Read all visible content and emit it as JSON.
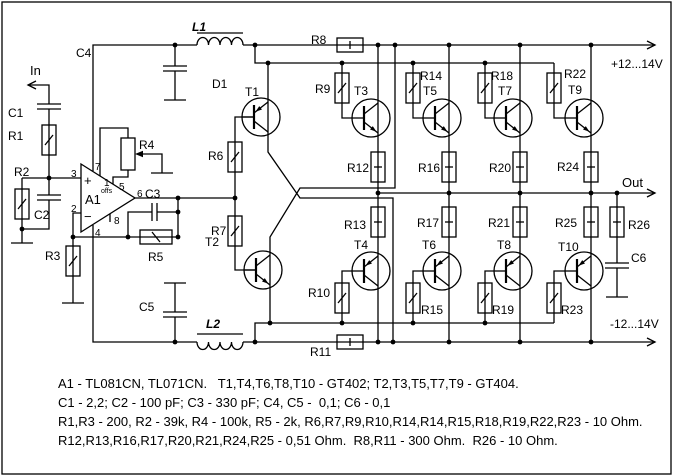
{
  "colors": {
    "positive": "#ff0000",
    "negative": "#0000ff",
    "wire": "#000000",
    "background": "#ffffff"
  },
  "ports": {
    "in": "In",
    "out": "Out"
  },
  "power": {
    "positive": "+12...14V",
    "negative": "-12...14V"
  },
  "opamp": {
    "ref": "A1",
    "plus": "+",
    "minus": "−",
    "offset_label": "offs",
    "pins": {
      "p1": "1",
      "p2": "2",
      "p3": "3",
      "p4": "4",
      "p5": "5",
      "p6": "6",
      "p7": "7",
      "p8": "8"
    }
  },
  "labels": {
    "c1": "C1",
    "r1": "R1",
    "r2": "R2",
    "c2": "C2",
    "r3": "R3",
    "r4": "R4",
    "c3": "C3",
    "r5": "R5",
    "c4": "C4",
    "c5": "C5",
    "c6": "C6",
    "l1": "L1",
    "l2": "L2",
    "d1": "D1",
    "r6": "R6",
    "r7": "R7",
    "t1": "T1",
    "t2": "T2",
    "r8": "R8",
    "r11": "R11",
    "r9": "R9",
    "r10": "R10",
    "r12": "R12",
    "r13": "R13",
    "t3": "T3",
    "t4": "T4",
    "r14": "R14",
    "r15": "R15",
    "r16": "R16",
    "r17": "R17",
    "t5": "T5",
    "t6": "T6",
    "r18": "R18",
    "r19": "R19",
    "r20": "R20",
    "r21": "R21",
    "t7": "T7",
    "t8": "T8",
    "r22": "R22",
    "r23": "R23",
    "r24": "R24",
    "r25": "R25",
    "t9": "T9",
    "t10": "T10",
    "r26": "R26"
  },
  "notes": {
    "line1": "A1 - TL081CN, TL071CN.   T1,T4,T6,T8,T10 - GT402; T2,T3,T5,T7,T9 - GT404.",
    "line2": "C1 - 2,2; C2 - 100 pF; C3 - 330 pF; C4, C5 -  0,1; C6 - 0,1",
    "line3": "R1,R3 - 200, R2 - 39k, R4 - 100k, R5 - 2k, R6,R7,R9,R10,R14,R14,R15,R18,R19,R22,R23 - 10 Ohm.",
    "line4": "R12,R13,R16,R17,R20,R21,R24,R25 - 0,51 Ohm.  R8,R11 - 300 Ohm.  R26 - 10 Ohm."
  }
}
